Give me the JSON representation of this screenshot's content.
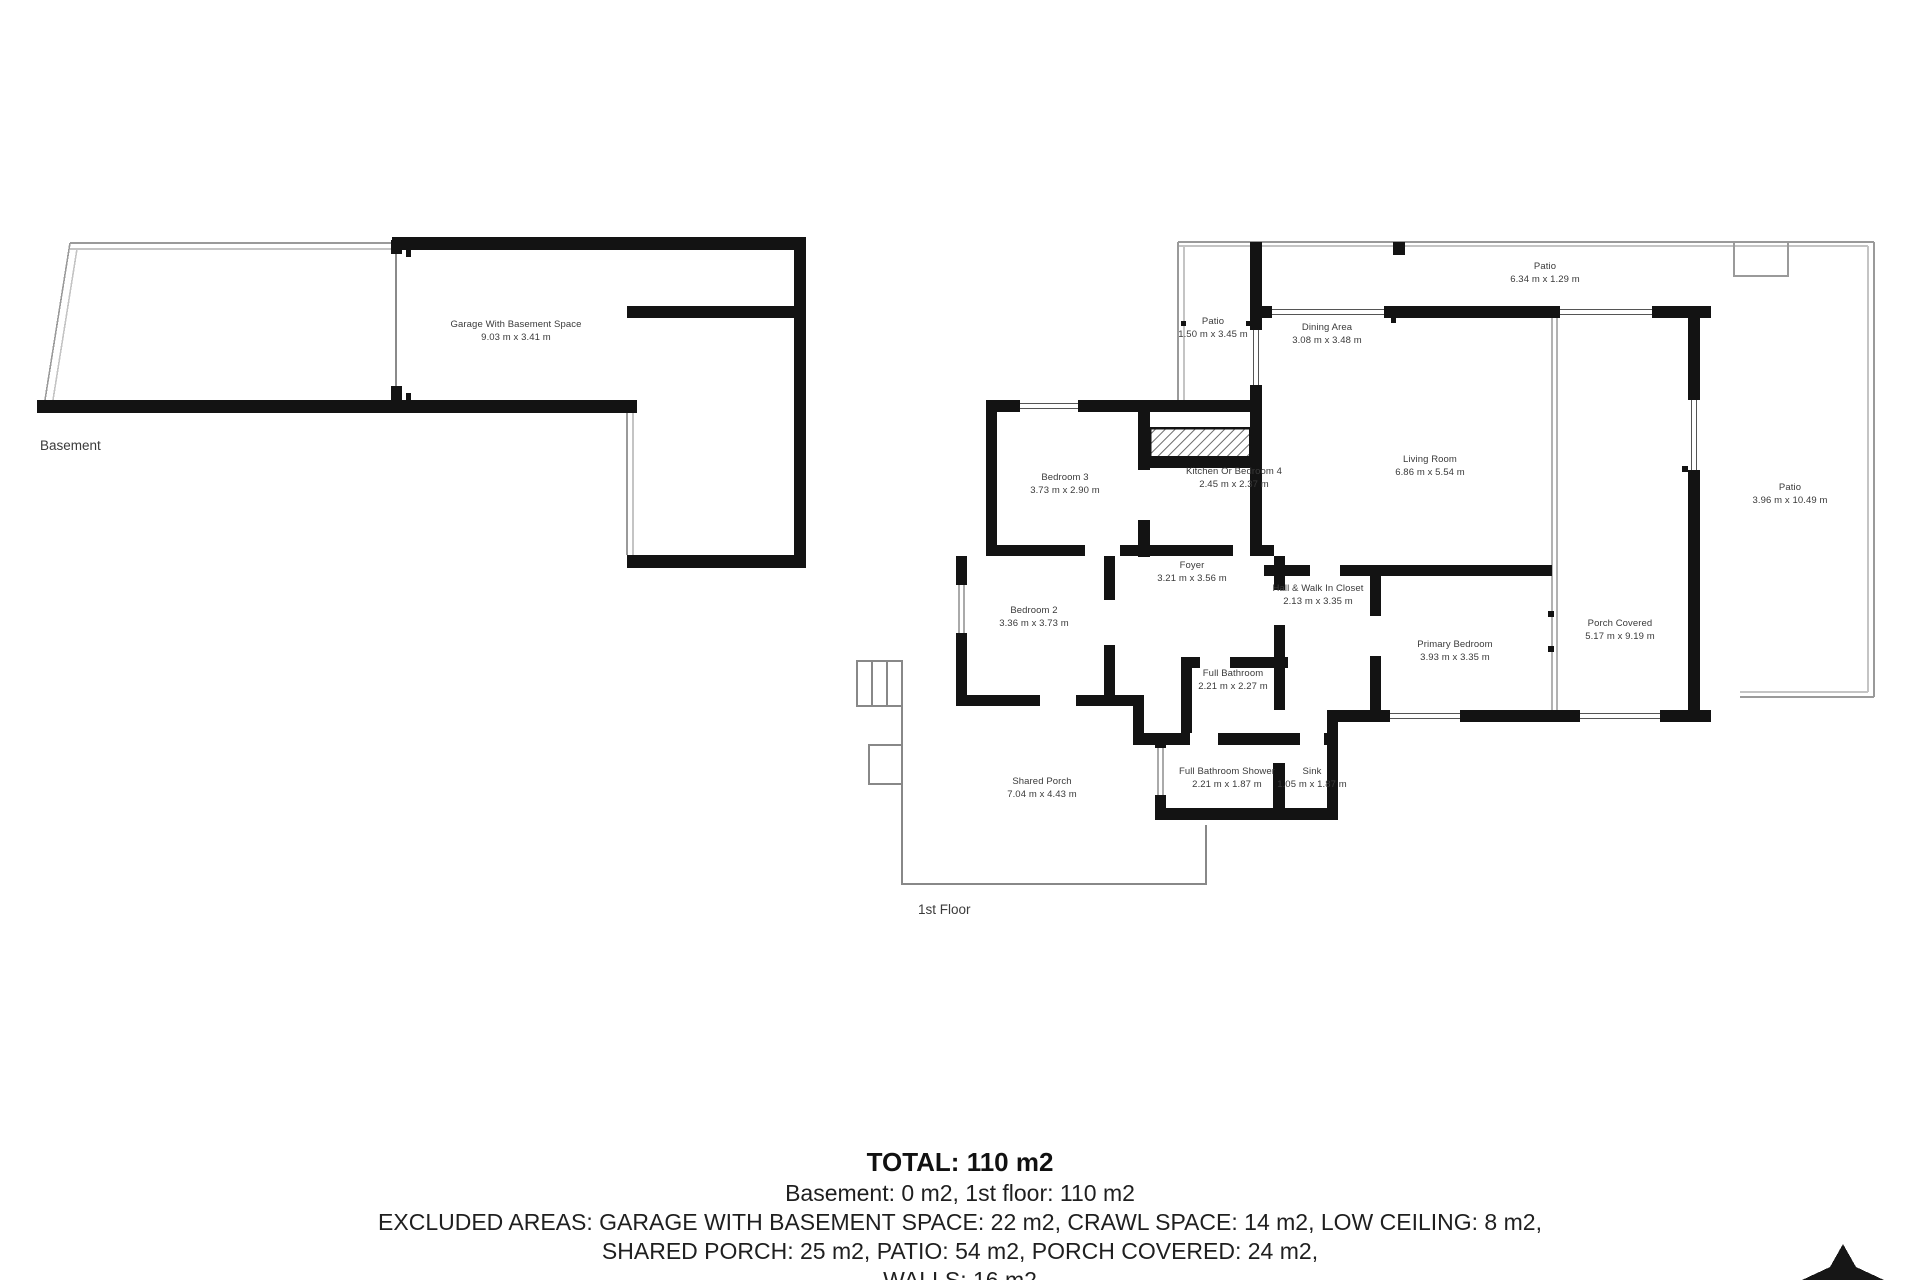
{
  "document": {
    "type": "floor-plan",
    "wall_color": "#131313",
    "boundary_color": "#9a9a9a",
    "text_color": "#3a3a3a"
  },
  "floors": {
    "basement_label": "Basement",
    "first_floor_label": "1st Floor"
  },
  "rooms": [
    {
      "name": "Garage With Basement Space",
      "dims": "9.03 m x 3.41 m"
    },
    {
      "name": "Patio",
      "dims": "6.34 m x 1.29 m"
    },
    {
      "name": "Patio",
      "dims": "1.50 m x 3.45 m"
    },
    {
      "name": "Dining Area",
      "dims": "3.08 m x 3.48 m"
    },
    {
      "name": "Living Room",
      "dims": "6.86 m x 5.54 m"
    },
    {
      "name": "Patio",
      "dims": "3.96 m x 10.49 m"
    },
    {
      "name": "Bedroom 3",
      "dims": "3.73 m x 2.90 m"
    },
    {
      "name": "Kitchen Or Bedroom 4",
      "dims": "2.45 m x 2.37 m"
    },
    {
      "name": "Foyer",
      "dims": "3.21 m x 3.56 m"
    },
    {
      "name": "Hall & Walk In Closet",
      "dims": "2.13 m x 3.35 m"
    },
    {
      "name": "Bedroom 2",
      "dims": "3.36 m x 3.73 m"
    },
    {
      "name": "Full Bathroom",
      "dims": "2.21 m x 2.27 m"
    },
    {
      "name": "Primary Bedroom",
      "dims": "3.93 m x 3.35 m"
    },
    {
      "name": "Porch Covered",
      "dims": "5.17 m x 9.19 m"
    },
    {
      "name": "Shared Porch",
      "dims": "7.04 m x 4.43 m"
    },
    {
      "name": "Full Bathroom Shower",
      "dims": "2.21 m x 1.87 m"
    },
    {
      "name": "Sink",
      "dims": "1.05 m x 1.87 m"
    }
  ],
  "summary": {
    "total": "TOTAL: 110 m2",
    "line2": "Basement: 0 m2, 1st floor: 110 m2",
    "line3": "EXCLUDED AREAS: GARAGE WITH BASEMENT SPACE: 22 m2, CRAWL SPACE: 14 m2, LOW CEILING: 8 m2,",
    "line4": "SHARED PORCH: 25 m2, PATIO: 54 m2, PORCH COVERED: 24 m2,",
    "line5": "WALLS: 16 m2"
  },
  "icons": {
    "logo": "north-arrow-logo"
  }
}
